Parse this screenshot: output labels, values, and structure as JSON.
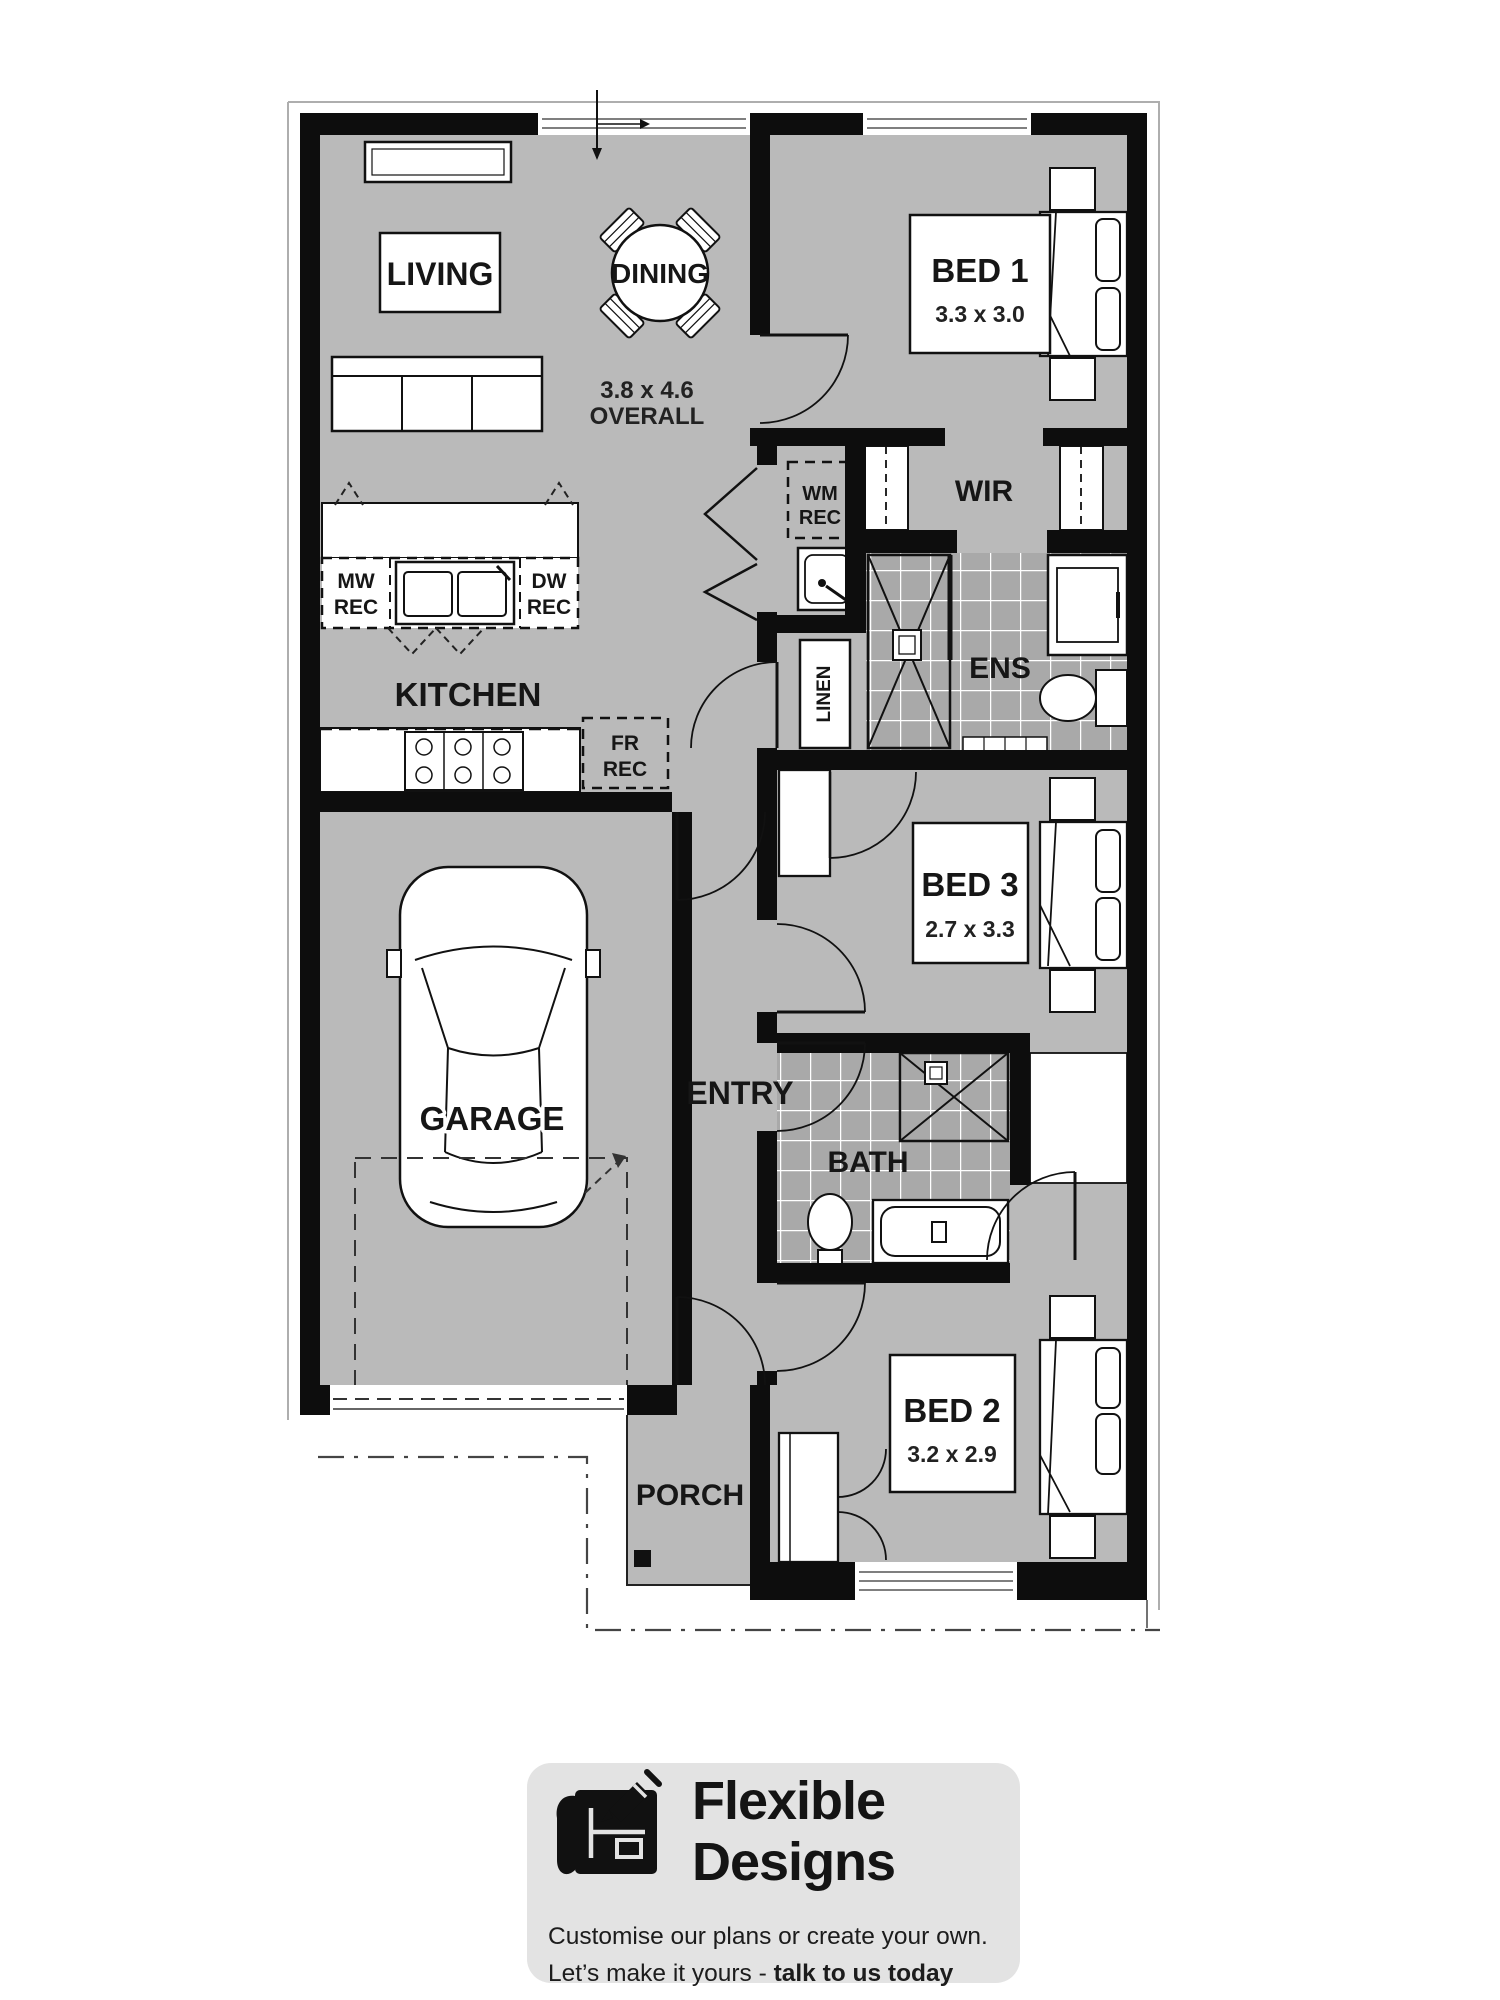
{
  "colors": {
    "floor": "#bababa",
    "tile": "#a9a9a9",
    "wall": "#0d0d0d",
    "footer_card": "#e3e3e3",
    "accent_text": "#141414"
  },
  "plan": {
    "living": {
      "label": "LIVING"
    },
    "dining": {
      "label": "DINING",
      "overall_line1": "3.8 x 4.6",
      "overall_line2": "OVERALL"
    },
    "bed1": {
      "label": "BED 1",
      "dims": "3.3 x 3.0"
    },
    "wir": {
      "label": "WIR"
    },
    "ens": {
      "label": "ENS"
    },
    "linen": {
      "label": "LINEN"
    },
    "kitchen": {
      "label": "KITCHEN"
    },
    "bed3": {
      "label": "BED 3",
      "dims": "2.7 x 3.3"
    },
    "garage": {
      "label": "GARAGE"
    },
    "entry": {
      "label": "ENTRY"
    },
    "bath": {
      "label": "BATH"
    },
    "bed2": {
      "label": "BED 2",
      "dims": "3.2 x 2.9"
    },
    "porch": {
      "label": "PORCH"
    },
    "recesses": {
      "wm": {
        "line1": "WM",
        "line2": "REC"
      },
      "mw": {
        "line1": "MW",
        "line2": "REC"
      },
      "dw": {
        "line1": "DW",
        "line2": "REC"
      },
      "fr": {
        "line1": "FR",
        "line2": "REC"
      }
    }
  },
  "footer": {
    "brand_line1": "Flexible",
    "brand_line2": "Designs",
    "tagline_line1": "Customise our plans or create your own.",
    "tagline_line2_prefix": "Let’s make it yours - ",
    "tagline_line2_bold": "talk to us today"
  }
}
